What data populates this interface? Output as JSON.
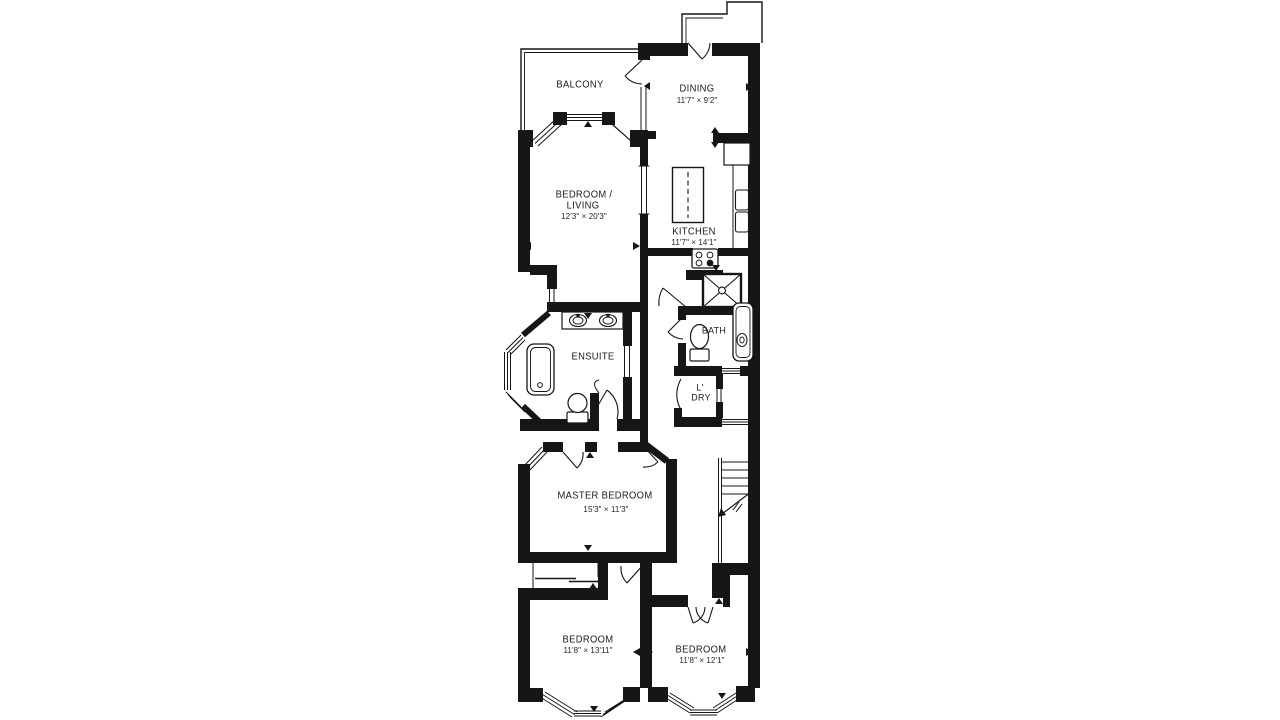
{
  "plan": {
    "background_color": "#ffffff",
    "wall_color": "#161616",
    "rooms": {
      "balcony": {
        "name": "BALCONY"
      },
      "dining": {
        "name": "DINING",
        "dims": "11'7\" × 9'2\""
      },
      "bedroom_living": {
        "line1": "BEDROOM /",
        "line2": "LIVING",
        "dims": "12'3\" × 20'3\""
      },
      "kitchen": {
        "name": "KITCHEN",
        "dims": "11'7\" × 14'1\""
      },
      "ensuite": {
        "name": "ENSUITE"
      },
      "bath": {
        "name": "BATH"
      },
      "laundry": {
        "line1": "L'",
        "line2": "DRY"
      },
      "master_bedroom": {
        "name": "MASTER BEDROOM",
        "dims": "15'3\" × 11'3\""
      },
      "bedroom_2": {
        "name": "BEDROOM",
        "dims": "11'8\" × 13'11\""
      },
      "bedroom_3": {
        "name": "BEDROOM",
        "dims": "11'8\" × 12'1\""
      }
    }
  }
}
